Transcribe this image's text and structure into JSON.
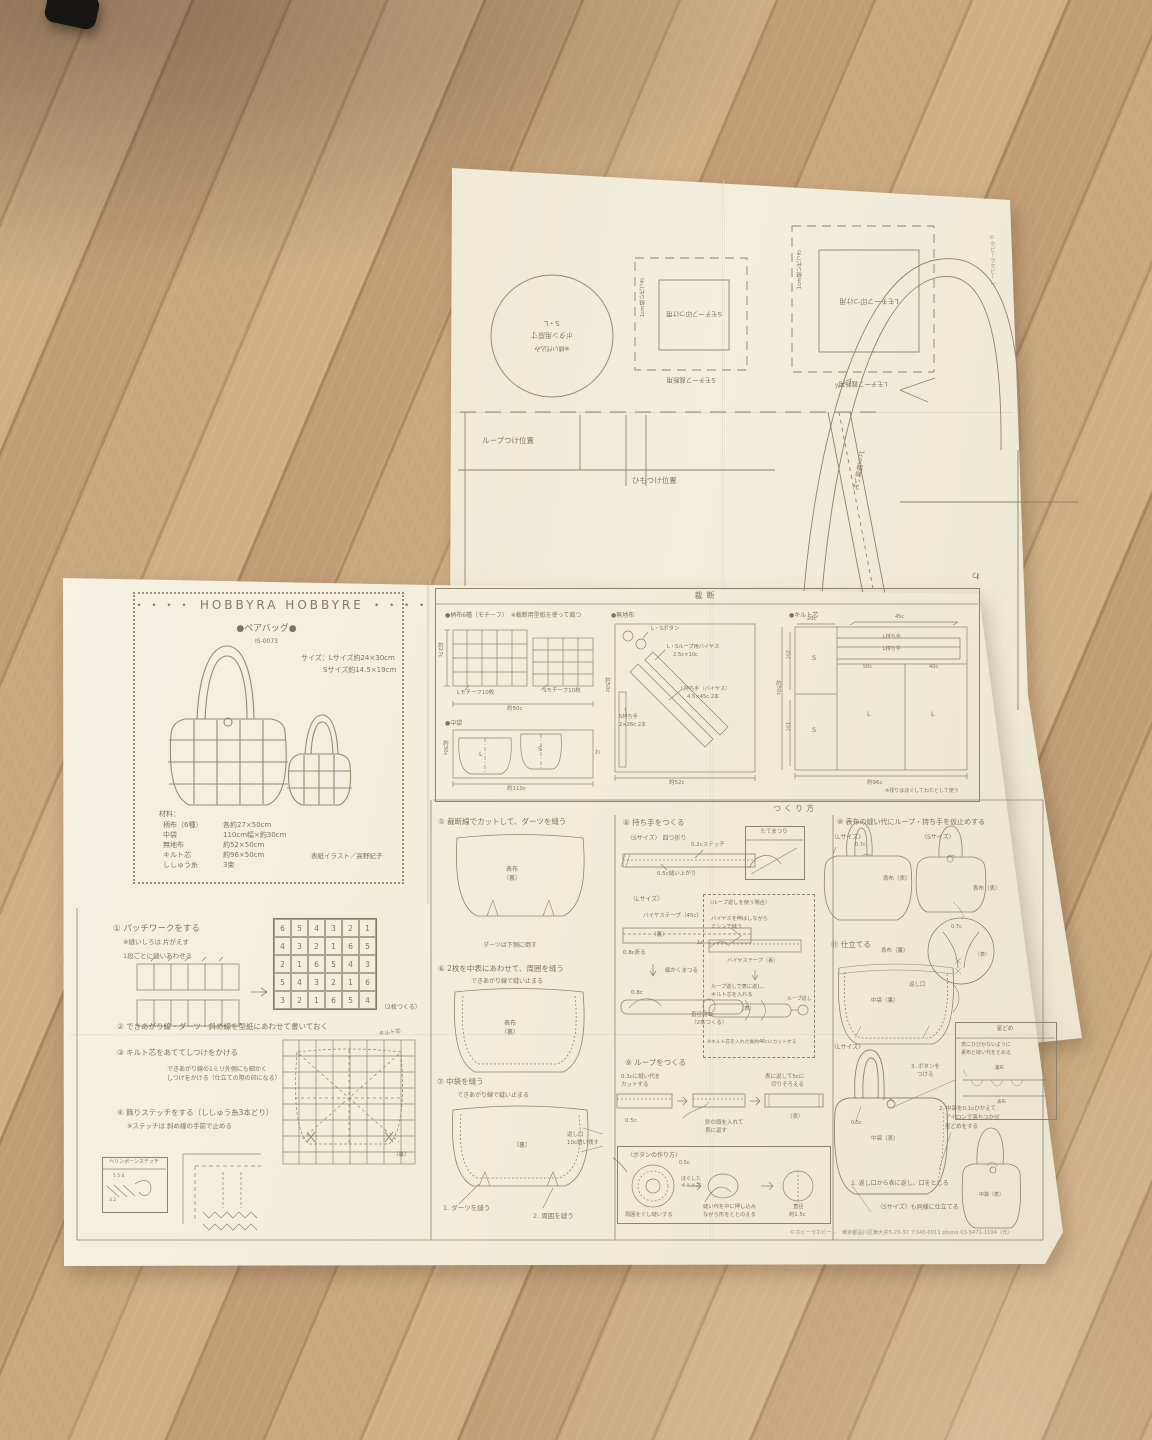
{
  "pattern_sheet": {
    "circle": {
      "l1": "S・L",
      "l2": "ボタン用原寸",
      "l3": "※縫い代込み"
    },
    "square_s": {
      "inner": "Sモチーフ印つけ用",
      "outer": "Sモチーフ裁断用",
      "side": "1cm縫い代つき"
    },
    "square_l": {
      "inner": "Lモチーフ印つけ用",
      "outer": "Lモチーフ裁断用",
      "side": "1cm縫い代つき"
    },
    "loop_pos": "ループつけ位置",
    "himo_pos": "ひもつけ位置",
    "bag_l": "ペアバッグL",
    "bag_s": "ペアバッグS",
    "wa_left": "わ",
    "wa_right": "わ",
    "loop": "ループ",
    "band": "1cm幅縫い代",
    "edge_note": "©ホビーラホビーレ"
  },
  "cover": {
    "brand": "・・・・ HOBBYRA HOBBYRE ・・・・",
    "title": "●ペアバッグ●",
    "item_no": "IS-0073",
    "size1": "サイズ：Lサイズ約24×30cm",
    "size2": "Sサイズ約14.5×19cm",
    "materials_title": "材料：",
    "materials": [
      {
        "name": "柄布（6種）",
        "qty": "各約27×50cm"
      },
      {
        "name": "中袋",
        "qty": "110cm幅×約30cm"
      },
      {
        "name": "無地布",
        "qty": "約52×50cm"
      },
      {
        "name": "キルト芯",
        "qty": "約96×50cm"
      },
      {
        "name": "ししゅう糸",
        "qty": "3束"
      }
    ],
    "credit": "表紙イラスト／高野紀子"
  },
  "cutting": {
    "header": "裁断",
    "motif": {
      "t": "●柄布6種（モチーフ）　※裁断用型紙を使って裁つ",
      "l": "Lモチーフ10枚",
      "s": "Sモチーフ10枚",
      "w": "約50c",
      "h": "約27c"
    },
    "lining": {
      "t": "●中袋",
      "l": "L",
      "s": "S",
      "w": "約110c",
      "h": "約30c",
      "wa": "わ"
    },
    "plain": {
      "t": "●無地布",
      "btn": "L・Sボタン",
      "b1": "L・Sループ用バイヤス",
      "b2": "2.5c×10c",
      "h1": "L持ち手（バイヤス）",
      "h2": "4.5×45c 2本",
      "s1": "S持ち手",
      "s2": "2×26c 2本",
      "w": "約52c",
      "h": "約50c"
    },
    "batting": {
      "t": "●キルト芯",
      "w20": "20c",
      "w45": "45c",
      "lh1": "L持ち手",
      "lh2": "L持ち手",
      "h25": "25c",
      "h15": "15c",
      "w50": "50c",
      "w40": "40c",
      "s1": "S",
      "s2": "S",
      "l1": "L",
      "l2": "L",
      "w": "約96c",
      "h": "約50c",
      "note": "※残りはほぐしてわたとして使う"
    }
  },
  "howto_header": "つくり方",
  "howto": {
    "s1": {
      "t": "① パッチワークをする",
      "n": "※縫いしろは 片がえす",
      "sub": "1段ごとに縫いあわせる",
      "make": "（2枚つくる）",
      "grid": [
        [
          6,
          5,
          4,
          3,
          2,
          1
        ],
        [
          4,
          3,
          2,
          1,
          6,
          5
        ],
        [
          2,
          1,
          6,
          5,
          4,
          3
        ],
        [
          5,
          4,
          3,
          2,
          1,
          6
        ],
        [
          3,
          2,
          1,
          6,
          5,
          4
        ]
      ]
    },
    "s2": {
      "t": "② できあがり線・ダーツ・斜め線を型紙にあわせて書いておく"
    },
    "s3": {
      "t": "③ キルト芯をあててしつけをかける",
      "n1": "できあがり線の1ミリ外側にも細かく",
      "n2": "しつけをかける（仕立ての際の印になる）",
      "batting": "キルト芯",
      "ura": "（裏）"
    },
    "s4": {
      "t": "④ 飾りステッチをする（ししゅう糸3本どり）",
      "n": "※ステッチは 斜め線の手前で止める",
      "box": "ヘリンボーンステッチ",
      "nums1": "1 5 4",
      "nums2": "3 2"
    },
    "s5": {
      "t": "⑤ 裁断線でカットして、ダーツを縫う",
      "l1": "表布",
      "l2": "（裏）",
      "n": "ダーツは下側に倒す"
    },
    "s6": {
      "t": "⑥ 2枚を中表にあわせて、周囲を縫う",
      "n": "できあがり線で縫い止まる",
      "l1": "表布",
      "l2": "（裏）"
    },
    "s7": {
      "t": "⑦ 中袋を縫う",
      "n": "できあがり線で縫い止まる",
      "l": "（裏）",
      "o1": "返し口",
      "o2": "10c縫い残す",
      "a": "1. ダーツを縫う",
      "b": "2. 周囲を縫う"
    },
    "s8": {
      "t": "⑧ 持ち手をつくる",
      "s": "〈Sサイズ〉 四つ折り",
      "st": "0.2cステッチ",
      "fin": "0.5c縫い上がり",
      "mat": "たてまつり",
      "lsize": "〈Lサイズ〉",
      "bias": "バイヤステープ（45c）",
      "ura": "（裏）",
      "fold": "0.8c折る",
      "fine": "細かくまつる",
      "w": "0.8c",
      "dia1": "直径約1c",
      "dia2": "（2本つくる）",
      "case": "〈ループ返しを使う場合〉",
      "c1": "バイヤスを伸ばしながら",
      "c2": "ミシンで縫う",
      "w1": "1c",
      "biasura": "バイヤステープ（裏）",
      "c3": "ループ返しで表に返し、",
      "c4": "キルト芯を入れる",
      "omote": "（表）",
      "tool": "ループ返し",
      "cut": "※キルト芯を入れた後約46cにカットする"
    },
    "s9": {
      "t": "⑨ ループをつくる",
      "c1": "0.3cに縫い代を",
      "c2": "カットする",
      "w": "0.5c",
      "t1": "針の頭を入れて",
      "t2": "表に返す",
      "r1": "表に返して5cに",
      "r2": "切りそろえる",
      "omote": "（表）"
    },
    "btn": {
      "t": "〈ボタンの作り方〉",
      "w": "0.5c",
      "c1": "ほぐした",
      "c2": "キルト芯",
      "g": "周囲をぐし縫いする",
      "p1": "縫い代を中に押し込み",
      "p2": "ながら形をととのえる",
      "d1": "直径",
      "d2": "約1.5c"
    },
    "s10": {
      "t": "⑩ 表布の縫い代にループ・持ち手を仮止めする",
      "l": "〈Lサイズ〉",
      "s": "〈Sサイズ〉",
      "w1": "0.7c",
      "lab1": "表布（表）",
      "lab2": "表布（表）",
      "w2": "0.7c",
      "omote": "（表）"
    },
    "s11": {
      "t": "⑪ 仕立てる",
      "top": "表布（裏）",
      "mid": "中袋（裏）",
      "op": "返し口",
      "hoshi": "星どめ",
      "h1": "表にひびかないように",
      "h2": "裏布と縫い代をとめる",
      "hura": "裏布",
      "homote": "表布",
      "l": "〈Lサイズ〉",
      "b3a": "3. ボタンを",
      "b3b": "つける",
      "w": "0.5c",
      "bag": "中袋（表）",
      "b2a": "2. 中袋を0.1cひかえて",
      "b2b": "アイロンで落ちつかせ",
      "b2c": "星どめをする",
      "b1": "1. 返し口から表に返し、口をとじる",
      "s": "〈Sサイズ〉も同様に仕立てる",
      "sbag": "中袋（表）"
    }
  },
  "footer": "©ホビーラホビーレ　東京都品川区東大井5-23-37 〒140-0011 phone.03-5471-1104（代）"
}
